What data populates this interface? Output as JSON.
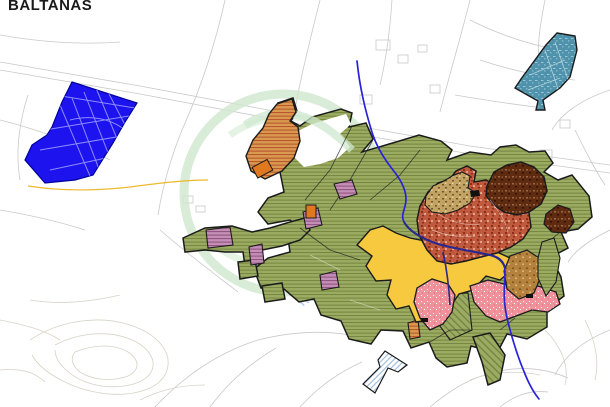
{
  "title": "BALTANÁS",
  "map": {
    "colors": {
      "background": "#ffffff",
      "cadastral": "#c9c9c9",
      "contour": "#d6d2c6",
      "watermark": "#cfe8cf",
      "outline": "#1b1b1b",
      "river": "#2a22d8",
      "road_navy": "#28288e",
      "road_yellow": "#edb92d",
      "blue_zone": "#1d13ee",
      "blue_streets": "#8c8cff",
      "blue_stroke": "#00009a",
      "teal_zone": "#4f92ab",
      "teal_streets": "#b0d2dd",
      "green_base": "#9cab62",
      "green_hatch": "#6f813c",
      "orange_zone": "#d79a4e",
      "orange_hatch": "#b94f2c",
      "mauve_zone": "#c48fb6",
      "mauve_hatch": "#8e4d7a",
      "yellow_zone": "#f6c93f",
      "pink_zone": "#f0929b",
      "pink_speckle": "#ffffff",
      "pink_dark": "#d9707e",
      "terracotta_zone": "#bf5a3e",
      "terracotta_dark": "#8f2f1a",
      "terracotta_light": "#dfa38c",
      "tan_zone": "#c2a364",
      "tan_dark": "#6f5a28",
      "brown_zone": "#5e2a10",
      "brown_light": "#9a6a48",
      "brown_dark": "#2f1204",
      "ochre_zone": "#b5823e",
      "ochre_dark": "#7c5520",
      "ochre_light": "#d9b27c",
      "stream_hatch": "#a8c8e8",
      "white_hatch_fill": "#ffffff",
      "white_hatch_lines": "#8fb2d6",
      "orange_parcel": "#e07820",
      "marker": "#111111"
    }
  }
}
